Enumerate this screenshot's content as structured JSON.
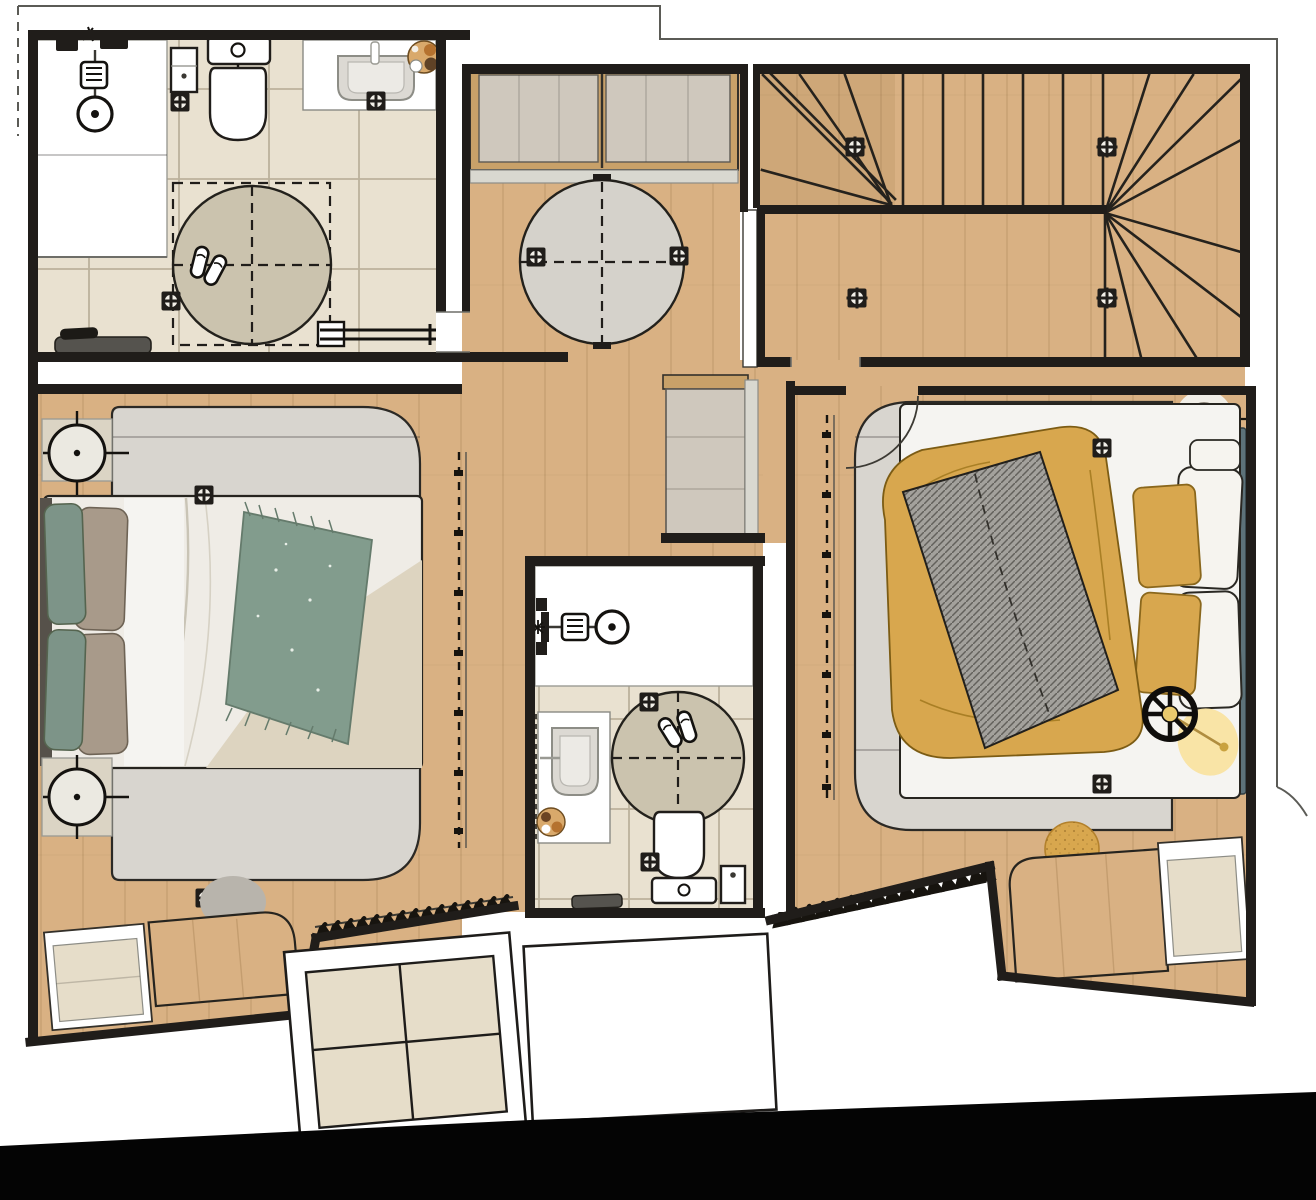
{
  "palette": {
    "wall": "#201d1a",
    "wood": "#d9b183",
    "woodFrame": "#c8a169",
    "tileBase": "#e9e1d0",
    "tileLine": "#bcb19c",
    "rugArea": "#d8d5cf",
    "rugEdge": "#2b2925",
    "rugRound": "#d5d2cb",
    "rugBath": "#cbc3ae",
    "basin": "#dcd9d3",
    "duvet": "#efece6",
    "duvetCream": "#ddd4c0",
    "sheet": "#f5f4f1",
    "throwGreen": "#829c8d",
    "pillowGreen": "#7d9488",
    "pillowTaupe": "#a89a8a",
    "headboard": "#56514a",
    "mustard": "#d8a74e",
    "mustardLine": "#8a671c",
    "blanket": "#a3a19c",
    "blanketLine": "#63615c",
    "teal": "#5d7279",
    "pendantRing": "#8e867c",
    "pendantCore": "#36332e",
    "glow": "#f8e2a0",
    "lampHub": "#e9c96d",
    "skylight": "#e6ddc9",
    "voidBlack": "#040404",
    "matBeige": "#dbd4c4",
    "panel": "#cfc8bd",
    "bandGrey": "#d9d8d0",
    "chair": "#b8b4ac",
    "doormat": "#55534e",
    "plant": "#d9a96b"
  },
  "plan": {
    "type": "upper-floor furnished plan, top-down render, no text labels",
    "rooms": [
      {
        "id": "bathroom-top-left",
        "fixtures": [
          "walk-in-shower",
          "shower-head",
          "shower-valve",
          "toilet",
          "toilet-side-cabinet",
          "vanity-sink",
          "towel-basket-plant",
          "round-rug-with-dashed-square",
          "slippers",
          "towel-rail",
          "doormat",
          "floor-grille",
          "floor-grille",
          "floor-grille"
        ]
      },
      {
        "id": "landing",
        "fixtures": [
          "built-in-wardrobe-two-sliding-panels",
          "round-rug-with-dashed-cross",
          "floor-grille",
          "floor-grille"
        ]
      },
      {
        "id": "staircase",
        "fixtures": [
          "left-winder-steps",
          "straight-flight",
          "half-landing",
          "right-winder-steps",
          "floor-grille",
          "floor-grille",
          "floor-grille",
          "floor-grille"
        ]
      },
      {
        "id": "bedroom-left",
        "fixtures": [
          "double-bed",
          "headboard",
          "green-pillows",
          "taupe-pillows",
          "green-throw",
          "area-rug",
          "round-nightstand",
          "round-nightstand",
          "sliding-wardrobe-dashed-front",
          "clothes-hanger-rail",
          "desk",
          "desk-chair",
          "dresser",
          "floor-grille",
          "floor-grille"
        ]
      },
      {
        "id": "bathroom-middle",
        "fixtures": [
          "walk-in-shower",
          "shower-head",
          "shower-valve",
          "vanity-sink",
          "towel-basket",
          "round-rug-with-dashed-cross",
          "slippers",
          "toilet",
          "toilet-brush-holder",
          "doormat",
          "floor-grille",
          "floor-grille"
        ]
      },
      {
        "id": "bedroom-right",
        "fixtures": [
          "double-bed",
          "teal-headboard-bench",
          "mustard-duvet",
          "grey-hatched-blanket",
          "mustard-pillows",
          "white-pillows",
          "pendant-light",
          "floor-lamp-with-glow",
          "pouf",
          "area-rug",
          "sliding-wardrobe-dashed-front",
          "clothes-hanger-rail",
          "desk",
          "dresser",
          "door-swing-arc",
          "floor-grille",
          "floor-grille"
        ]
      }
    ],
    "exterior": [
      "thin-roof-outline",
      "skylight-grid-left",
      "skylight-blank-middle",
      "black-void-bottom"
    ],
    "counts": {
      "floor_grilles": 15,
      "hangers_left": 15,
      "hangers_right": 16,
      "slipper_pairs": 2,
      "round_rugs": 3,
      "beds": 2
    }
  }
}
